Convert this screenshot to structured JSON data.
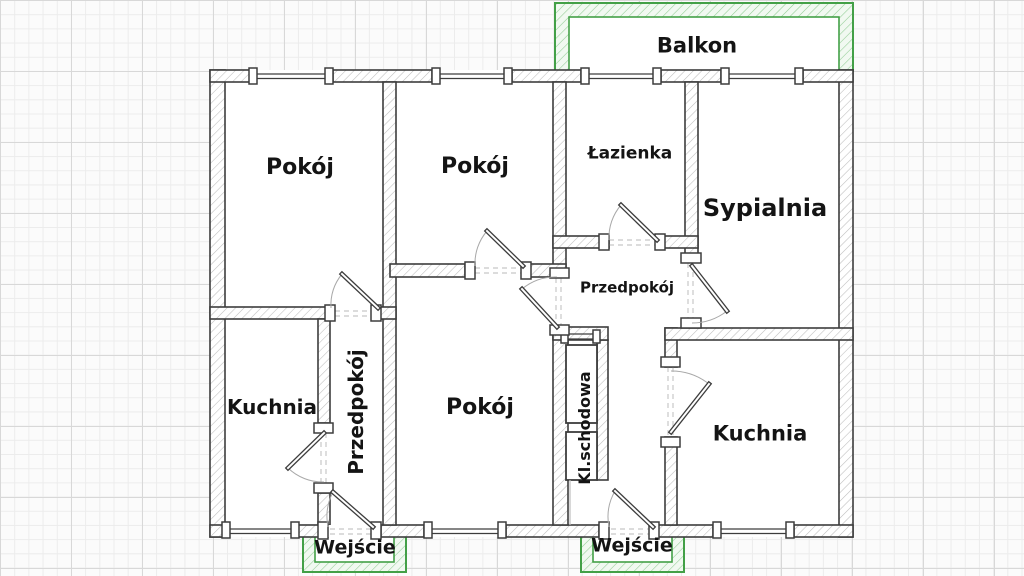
{
  "rooms": {
    "pokoj_top_left": {
      "label": "Pokój"
    },
    "pokoj_top_middle": {
      "label": "Pokój"
    },
    "lazienka": {
      "label": "Łazienka"
    },
    "sypialnia": {
      "label": "Sypialnia"
    },
    "przedpokoj_central": {
      "label": "Przedpokój"
    },
    "kuchnia_left": {
      "label": "Kuchnia"
    },
    "przedpokoj_corridor": {
      "label": "Przedpokój"
    },
    "pokoj_bottom_middle": {
      "label": "Pokój"
    },
    "kl_schodowa": {
      "label": "Kl.schodowa"
    },
    "kuchnia_right": {
      "label": "Kuchnia"
    }
  },
  "exterior": {
    "balkon": {
      "label": "Balkon"
    },
    "wejscie_left": {
      "label": "Wejście"
    },
    "wejscie_bottom": {
      "label": "Wejście"
    }
  },
  "colors": {
    "accent_green": "#43a047",
    "accent_green_soft": "#f1f9f1",
    "accent_green_hatch": "#90cc93",
    "wall_stroke": "#3d3d3d",
    "wall_hatch": "#bdbdbd",
    "label_text": "#141414",
    "grid_minor": "#ececec",
    "grid_major": "#d8d8d8",
    "door_arc": "#a8a8a8"
  }
}
